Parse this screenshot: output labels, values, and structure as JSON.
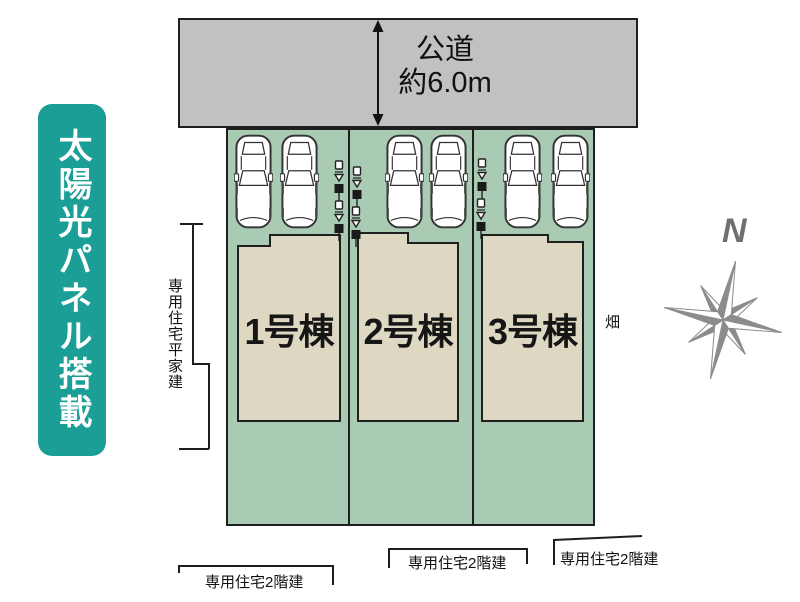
{
  "banner": {
    "text": "太陽光パネル搭載"
  },
  "road": {
    "name": "公道",
    "width_label": "約6.0m"
  },
  "lots": [
    {
      "building_label": "1号棟"
    },
    {
      "building_label": "2号棟"
    },
    {
      "building_label": "3号棟"
    }
  ],
  "neighbors": {
    "west_label": "専用住宅平家建",
    "east_label": "畑",
    "south_labels": [
      "専用住宅2階建",
      "専用住宅2階建",
      "専用住宅2階建"
    ]
  },
  "compass": {
    "north_label": "N"
  },
  "colors": {
    "banner_teal": "#1b9e96",
    "road_gray": "#c1c0c2",
    "lot_green": "#a9cab3",
    "building_beige": "#ded8c3",
    "line_black": "#1f1f1f",
    "compass_gray": "#8c8c8c"
  }
}
